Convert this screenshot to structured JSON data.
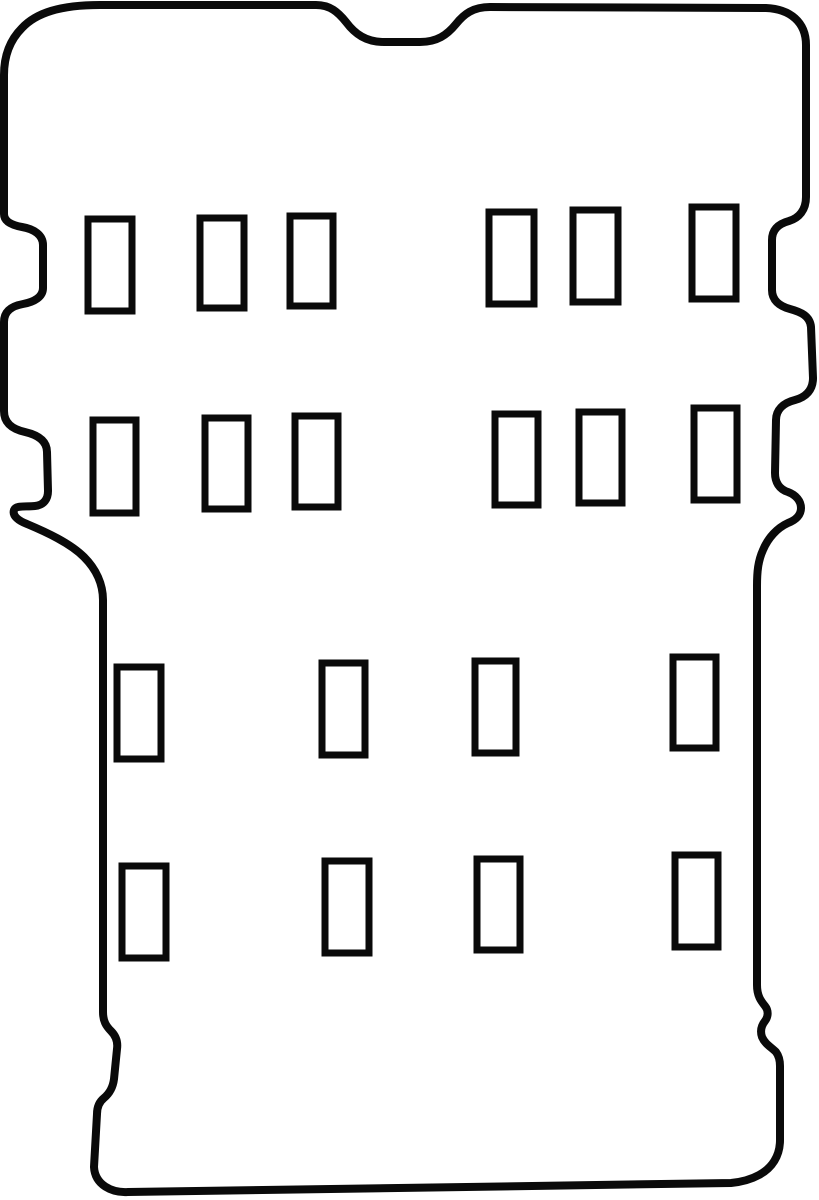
{
  "meta": {
    "description": "Line-art outline template of a vehicle floor mat / boot liner with rectangular fixing slots",
    "canvas": {
      "width": 819,
      "height": 1200
    }
  },
  "colors": {
    "background": "#ffffff",
    "line": "#0a0a0a"
  },
  "outline": {
    "stroke_width": 8,
    "path": "M 100,5 L 316,5 C 330,5 338,12 346,22 C 355,34 366,42 384,42 L 420,42 C 437,42 447,35 456,24 C 464,14 473,7 490,7 L 766,8 C 790,9 806,22 806,45 L 806,197 C 806,210 799,218 789,221 C 778,224 772,230 772,240 L 772,290 C 772,300 779,306 790,309 C 801,312 810,316 811,327 L 813,378 C 813,390 806,397 795,400 C 783,403 776,410 776,420 L 775,473 C 775,482 779,489 788,492 C 796,495 801,501 801,508 C 801,515 796,520 788,523 C 777,528 768,538 763,550 C 758,561 757,572 757,586 L 757,985 C 757,996 761,1001 765,1006 C 769,1011 768,1017 765,1021 C 761,1026 760,1031 762,1037 C 765,1044 771,1047 776,1052 C 779,1056 780,1060 780,1066 L 780,1140 C 780,1156 772,1168 759,1175 C 750,1180 741,1182 731,1183 L 128,1192 C 112,1193 95,1185 94,1167 L 97,1114 C 97,1107 99,1102 104,1098 C 110,1093 113,1087 114,1079 L 117,1049 C 118,1042 116,1036 111,1031 C 106,1026 103,1021 103,1012 L 103,600 C 103,584 96,569 84,557 C 70,543 46,532 27,524 C 19,521 12,516 14,510 C 16,505 25,507 35,506 C 44,505 48,499 48,491 L 47,452 C 47,441 38,435 25,432 C 12,429 4,423 4,411 L 4,322 C 4,311 12,306 23,304 C 34,302 43,297 43,288 L 43,245 C 43,235 34,229 22,227 C 11,225 4,221 4,214 L 4,75 C 4,55 10,40 22,28 C 36,13 60,5 100,5 Z"
  },
  "slots": {
    "stroke_width": 7,
    "items": [
      {
        "row": 1,
        "x": 88,
        "y": 219,
        "width": 44,
        "height": 92
      },
      {
        "row": 1,
        "x": 200,
        "y": 218,
        "width": 44,
        "height": 90
      },
      {
        "row": 1,
        "x": 290,
        "y": 216,
        "width": 43,
        "height": 90
      },
      {
        "row": 1,
        "x": 489,
        "y": 212,
        "width": 45,
        "height": 92
      },
      {
        "row": 1,
        "x": 573,
        "y": 210,
        "width": 45,
        "height": 92
      },
      {
        "row": 1,
        "x": 692,
        "y": 207,
        "width": 44,
        "height": 92
      },
      {
        "row": 2,
        "x": 93,
        "y": 420,
        "width": 43,
        "height": 93
      },
      {
        "row": 2,
        "x": 205,
        "y": 418,
        "width": 43,
        "height": 91
      },
      {
        "row": 2,
        "x": 295,
        "y": 416,
        "width": 43,
        "height": 91
      },
      {
        "row": 2,
        "x": 495,
        "y": 414,
        "width": 43,
        "height": 91
      },
      {
        "row": 2,
        "x": 579,
        "y": 412,
        "width": 43,
        "height": 91
      },
      {
        "row": 2,
        "x": 694,
        "y": 408,
        "width": 43,
        "height": 92
      },
      {
        "row": 3,
        "x": 117,
        "y": 667,
        "width": 44,
        "height": 92
      },
      {
        "row": 3,
        "x": 322,
        "y": 663,
        "width": 43,
        "height": 92
      },
      {
        "row": 3,
        "x": 475,
        "y": 661,
        "width": 41,
        "height": 92
      },
      {
        "row": 3,
        "x": 673,
        "y": 657,
        "width": 43,
        "height": 91
      },
      {
        "row": 4,
        "x": 122,
        "y": 866,
        "width": 44,
        "height": 92
      },
      {
        "row": 4,
        "x": 325,
        "y": 861,
        "width": 44,
        "height": 92
      },
      {
        "row": 4,
        "x": 477,
        "y": 859,
        "width": 43,
        "height": 91
      },
      {
        "row": 4,
        "x": 675,
        "y": 855,
        "width": 43,
        "height": 92
      }
    ]
  }
}
